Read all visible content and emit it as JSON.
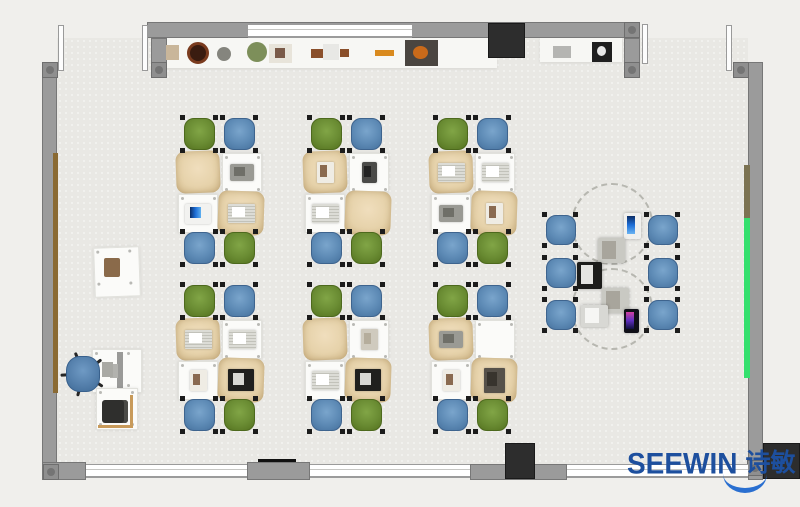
{
  "meta": {
    "title": "Classroom furniture floor plan render",
    "width": 800,
    "height": 507
  },
  "branding": {
    "logo_text": "SEEWIN",
    "logo_cn": "诗敏"
  },
  "palette": {
    "floor": "#e9e8e4",
    "outside": "#f0efec",
    "wall": "#9b9b9b",
    "wall-border": "#777777",
    "wall-post": "#8f8f8f",
    "chair-green": "#6a8c33",
    "chair-blue": "#5d8ab5",
    "desk-tan": "#e6d2aa",
    "desk-white": "#fbfbf9",
    "cabinet-dark": "#2d2d2d",
    "strip-green": "#35e06e",
    "strip-olive": "#7c7352",
    "strip-brown": "#8a6a33",
    "office-chair-blue": "#5580ac",
    "logo-blue": "#1d4f9e",
    "logo-swoosh": "#2a6fd0"
  },
  "room": {
    "floor": {
      "x": 57,
      "y": 38,
      "w": 691,
      "h": 427
    },
    "walls": [
      {
        "name": "top-wall",
        "x": 147,
        "y": 22,
        "w": 493,
        "h": 16
      },
      {
        "name": "topleft-stub",
        "x": 151,
        "y": 38,
        "w": 16,
        "h": 40
      },
      {
        "name": "left-wall",
        "x": 42,
        "y": 62,
        "w": 15,
        "h": 418
      },
      {
        "name": "right-wall",
        "x": 748,
        "y": 62,
        "w": 15,
        "h": 418
      },
      {
        "name": "topright-stub",
        "x": 624,
        "y": 38,
        "w": 16,
        "h": 40
      },
      {
        "name": "topright-link",
        "x": 733,
        "y": 62,
        "w": 16,
        "h": 16
      },
      {
        "name": "bottom-corner-left",
        "x": 42,
        "y": 462,
        "w": 44,
        "h": 18
      },
      {
        "name": "bottom-pillar",
        "x": 247,
        "y": 462,
        "w": 63,
        "h": 18
      },
      {
        "name": "bottom-segment",
        "x": 470,
        "y": 464,
        "w": 97,
        "h": 16
      }
    ],
    "posts": [
      {
        "x": 42,
        "y": 62
      },
      {
        "x": 151,
        "y": 62
      },
      {
        "x": 624,
        "y": 22
      },
      {
        "x": 624,
        "y": 62
      },
      {
        "x": 733,
        "y": 62
      },
      {
        "x": 43,
        "y": 464
      },
      {
        "x": 747,
        "y": 460
      }
    ],
    "windows": [
      {
        "name": "top-window",
        "x": 248,
        "y": 24,
        "w": 164,
        "h": 14
      },
      {
        "name": "bottom-window-1",
        "x": 86,
        "y": 464,
        "w": 161,
        "h": 14
      },
      {
        "name": "bottom-window-2",
        "x": 310,
        "y": 464,
        "w": 160,
        "h": 14
      },
      {
        "name": "bottom-window-3",
        "x": 567,
        "y": 464,
        "w": 181,
        "h": 14
      }
    ],
    "doors": [
      {
        "x": 58,
        "y": 25,
        "w": 6,
        "h": 46
      },
      {
        "x": 142,
        "y": 25,
        "w": 6,
        "h": 46
      },
      {
        "x": 642,
        "y": 24,
        "w": 6,
        "h": 40
      },
      {
        "x": 726,
        "y": 25,
        "w": 6,
        "h": 46
      }
    ],
    "strips": [
      {
        "name": "left-wood-rail",
        "x": 53,
        "y": 153,
        "w": 5,
        "h": 240,
        "color": "strip-brown"
      },
      {
        "name": "right-olive-board",
        "x": 744,
        "y": 165,
        "w": 6,
        "h": 53,
        "color": "strip-olive"
      },
      {
        "name": "right-green-board",
        "x": 744,
        "y": 218,
        "w": 6,
        "h": 160,
        "color": "strip-green"
      }
    ],
    "cabinets": [
      {
        "name": "cabinet-top",
        "x": 488,
        "y": 23,
        "w": 37,
        "h": 35
      },
      {
        "name": "cabinet-bottom",
        "x": 505,
        "y": 443,
        "w": 30,
        "h": 36
      },
      {
        "name": "cabinet-corner",
        "x": 763,
        "y": 443,
        "w": 37,
        "h": 36
      }
    ],
    "counters": [
      {
        "name": "top-counter",
        "x": 160,
        "y": 38,
        "w": 337,
        "h": 30
      },
      {
        "name": "right-shelf",
        "x": 540,
        "y": 38,
        "w": 82,
        "h": 24
      }
    ],
    "black_trim": {
      "x": 258,
      "y": 459,
      "w": 38,
      "h": 3
    }
  },
  "shelf_items": [
    {
      "name": "tan-box",
      "shape": "rect",
      "x": 166,
      "y": 45,
      "w": 13,
      "h": 15,
      "color": "#c9b69a"
    },
    {
      "name": "brown-bowl",
      "shape": "ring",
      "x": 187,
      "y": 42,
      "w": 22,
      "h": 22,
      "color": "#7a3b1e",
      "inner": "#3a1c10"
    },
    {
      "name": "gray-stone",
      "shape": "circle",
      "x": 217,
      "y": 47,
      "w": 14,
      "h": 14,
      "color": "#85857e"
    },
    {
      "name": "green-plant",
      "shape": "circle",
      "x": 247,
      "y": 42,
      "w": 20,
      "h": 20,
      "color": "#7d8f5a"
    },
    {
      "name": "photo-frame",
      "shape": "frame",
      "x": 269,
      "y": 44,
      "w": 23,
      "h": 19,
      "color": "#e8e4da",
      "inner": "#7a5a48"
    },
    {
      "name": "wood-stick",
      "shape": "rect",
      "x": 311,
      "y": 49,
      "w": 12,
      "h": 9,
      "color": "#8a4f2a"
    },
    {
      "name": "white-cup",
      "shape": "rect",
      "x": 323,
      "y": 44,
      "w": 16,
      "h": 16,
      "color": "#e8e8e5"
    },
    {
      "name": "wood-stick-2",
      "shape": "rect",
      "x": 340,
      "y": 49,
      "w": 9,
      "h": 8,
      "color": "#8a4f2a"
    },
    {
      "name": "orange-tray",
      "shape": "rect",
      "x": 375,
      "y": 50,
      "w": 19,
      "h": 6,
      "color": "#d98a1e"
    },
    {
      "name": "sewing-machine",
      "shape": "frame",
      "x": 405,
      "y": 40,
      "w": 33,
      "h": 26,
      "color": "#4a4540",
      "inner": "#c96a1a"
    },
    {
      "name": "gray-box",
      "shape": "rect",
      "x": 553,
      "y": 46,
      "w": 18,
      "h": 12,
      "color": "#b5b5b2"
    },
    {
      "name": "black-device",
      "shape": "frame",
      "x": 592,
      "y": 42,
      "w": 20,
      "h": 20,
      "color": "#1f1f1f",
      "inner": "#e8e8e8"
    }
  ],
  "clusters": {
    "origins": [
      [
        178,
        118
      ],
      [
        305,
        118
      ],
      [
        431,
        118
      ],
      [
        178,
        285
      ],
      [
        305,
        285
      ],
      [
        431,
        285
      ]
    ],
    "chairs": [
      {
        "dx": 6,
        "dy": 0,
        "color": "green"
      },
      {
        "dx": 46,
        "dy": 0,
        "color": "blue"
      },
      {
        "dx": 6,
        "dy": 114,
        "color": "blue"
      },
      {
        "dx": 46,
        "dy": 114,
        "color": "green"
      }
    ],
    "chair_size": {
      "w": 31,
      "h": 32
    },
    "desks": [
      {
        "dx": -2,
        "dy": 33,
        "w": 44,
        "h": 42,
        "style": "tan",
        "rot": -2
      },
      {
        "dx": 44,
        "dy": 35,
        "w": 40,
        "h": 39,
        "style": "white",
        "rot": 0
      },
      {
        "dx": 0,
        "dy": 76,
        "w": 40,
        "h": 39,
        "style": "white",
        "rot": 0
      },
      {
        "dx": 40,
        "dy": 73,
        "w": 46,
        "h": 44,
        "style": "tan",
        "rot": 2
      }
    ],
    "desk_items": [
      [
        "none",
        "laptop",
        "laptop-blue",
        "open-book"
      ],
      [
        "photo",
        "tablet",
        "open-book",
        "none"
      ],
      [
        "open-book",
        "open-book",
        "laptop",
        "photo"
      ],
      [
        "open-book",
        "open-book",
        "photo",
        "laptop-black"
      ],
      [
        "none",
        "book",
        "open-book",
        "laptop-black"
      ],
      [
        "laptop",
        "none",
        "photo",
        "book-dark"
      ]
    ]
  },
  "collab": {
    "circles": [
      {
        "cx": 612,
        "cy": 224,
        "r": 41
      },
      {
        "cx": 612,
        "cy": 309,
        "r": 41
      }
    ],
    "chairs": [
      [
        546,
        215
      ],
      [
        546,
        258
      ],
      [
        546,
        300
      ],
      [
        648,
        215
      ],
      [
        648,
        258
      ],
      [
        648,
        300
      ]
    ],
    "chair_size": {
      "w": 30,
      "h": 30
    },
    "devices": [
      {
        "type": "laptop-blue-v",
        "x": 624,
        "y": 213,
        "w": 17,
        "h": 26
      },
      {
        "type": "tablet-sketch",
        "x": 598,
        "y": 238,
        "w": 27,
        "h": 25
      },
      {
        "type": "laptop-black",
        "x": 577,
        "y": 262,
        "w": 25,
        "h": 27
      },
      {
        "type": "tablet-sketch",
        "x": 602,
        "y": 288,
        "w": 27,
        "h": 25
      },
      {
        "type": "laptop-white",
        "x": 581,
        "y": 305,
        "w": 27,
        "h": 22
      },
      {
        "type": "phone-color",
        "x": 624,
        "y": 309,
        "w": 15,
        "h": 24
      }
    ]
  },
  "teacher": {
    "side_desk": {
      "x": 94,
      "y": 247,
      "w": 46,
      "h": 50,
      "rot": -2
    },
    "side_desk_book": {
      "x": 104,
      "y": 258,
      "w": 16,
      "h": 19,
      "color": "#8a6a4a"
    },
    "main_desk": {
      "x": 92,
      "y": 349,
      "w": 50,
      "h": 44
    },
    "monitor": {
      "x": 117,
      "y": 352,
      "w": 6,
      "h": 38
    },
    "monitor_base": {
      "x": 110,
      "y": 364,
      "w": 8,
      "h": 14
    },
    "keyboard": {
      "x": 102,
      "y": 362,
      "w": 11,
      "h": 15
    },
    "office_chair": {
      "x": 64,
      "y": 354,
      "w": 38,
      "h": 40
    },
    "lower_desk": {
      "x": 96,
      "y": 388,
      "w": 42,
      "h": 42
    },
    "printer": {
      "x": 102,
      "y": 400,
      "w": 26,
      "h": 23
    },
    "bracket_v": {
      "x": 130,
      "y": 395,
      "w": 3,
      "h": 33,
      "color": "#c89a5a"
    },
    "bracket_h": {
      "x": 98,
      "y": 425,
      "w": 35,
      "h": 3,
      "color": "#c89a5a"
    }
  },
  "logo_pos": {
    "x": 627,
    "y": 450
  }
}
